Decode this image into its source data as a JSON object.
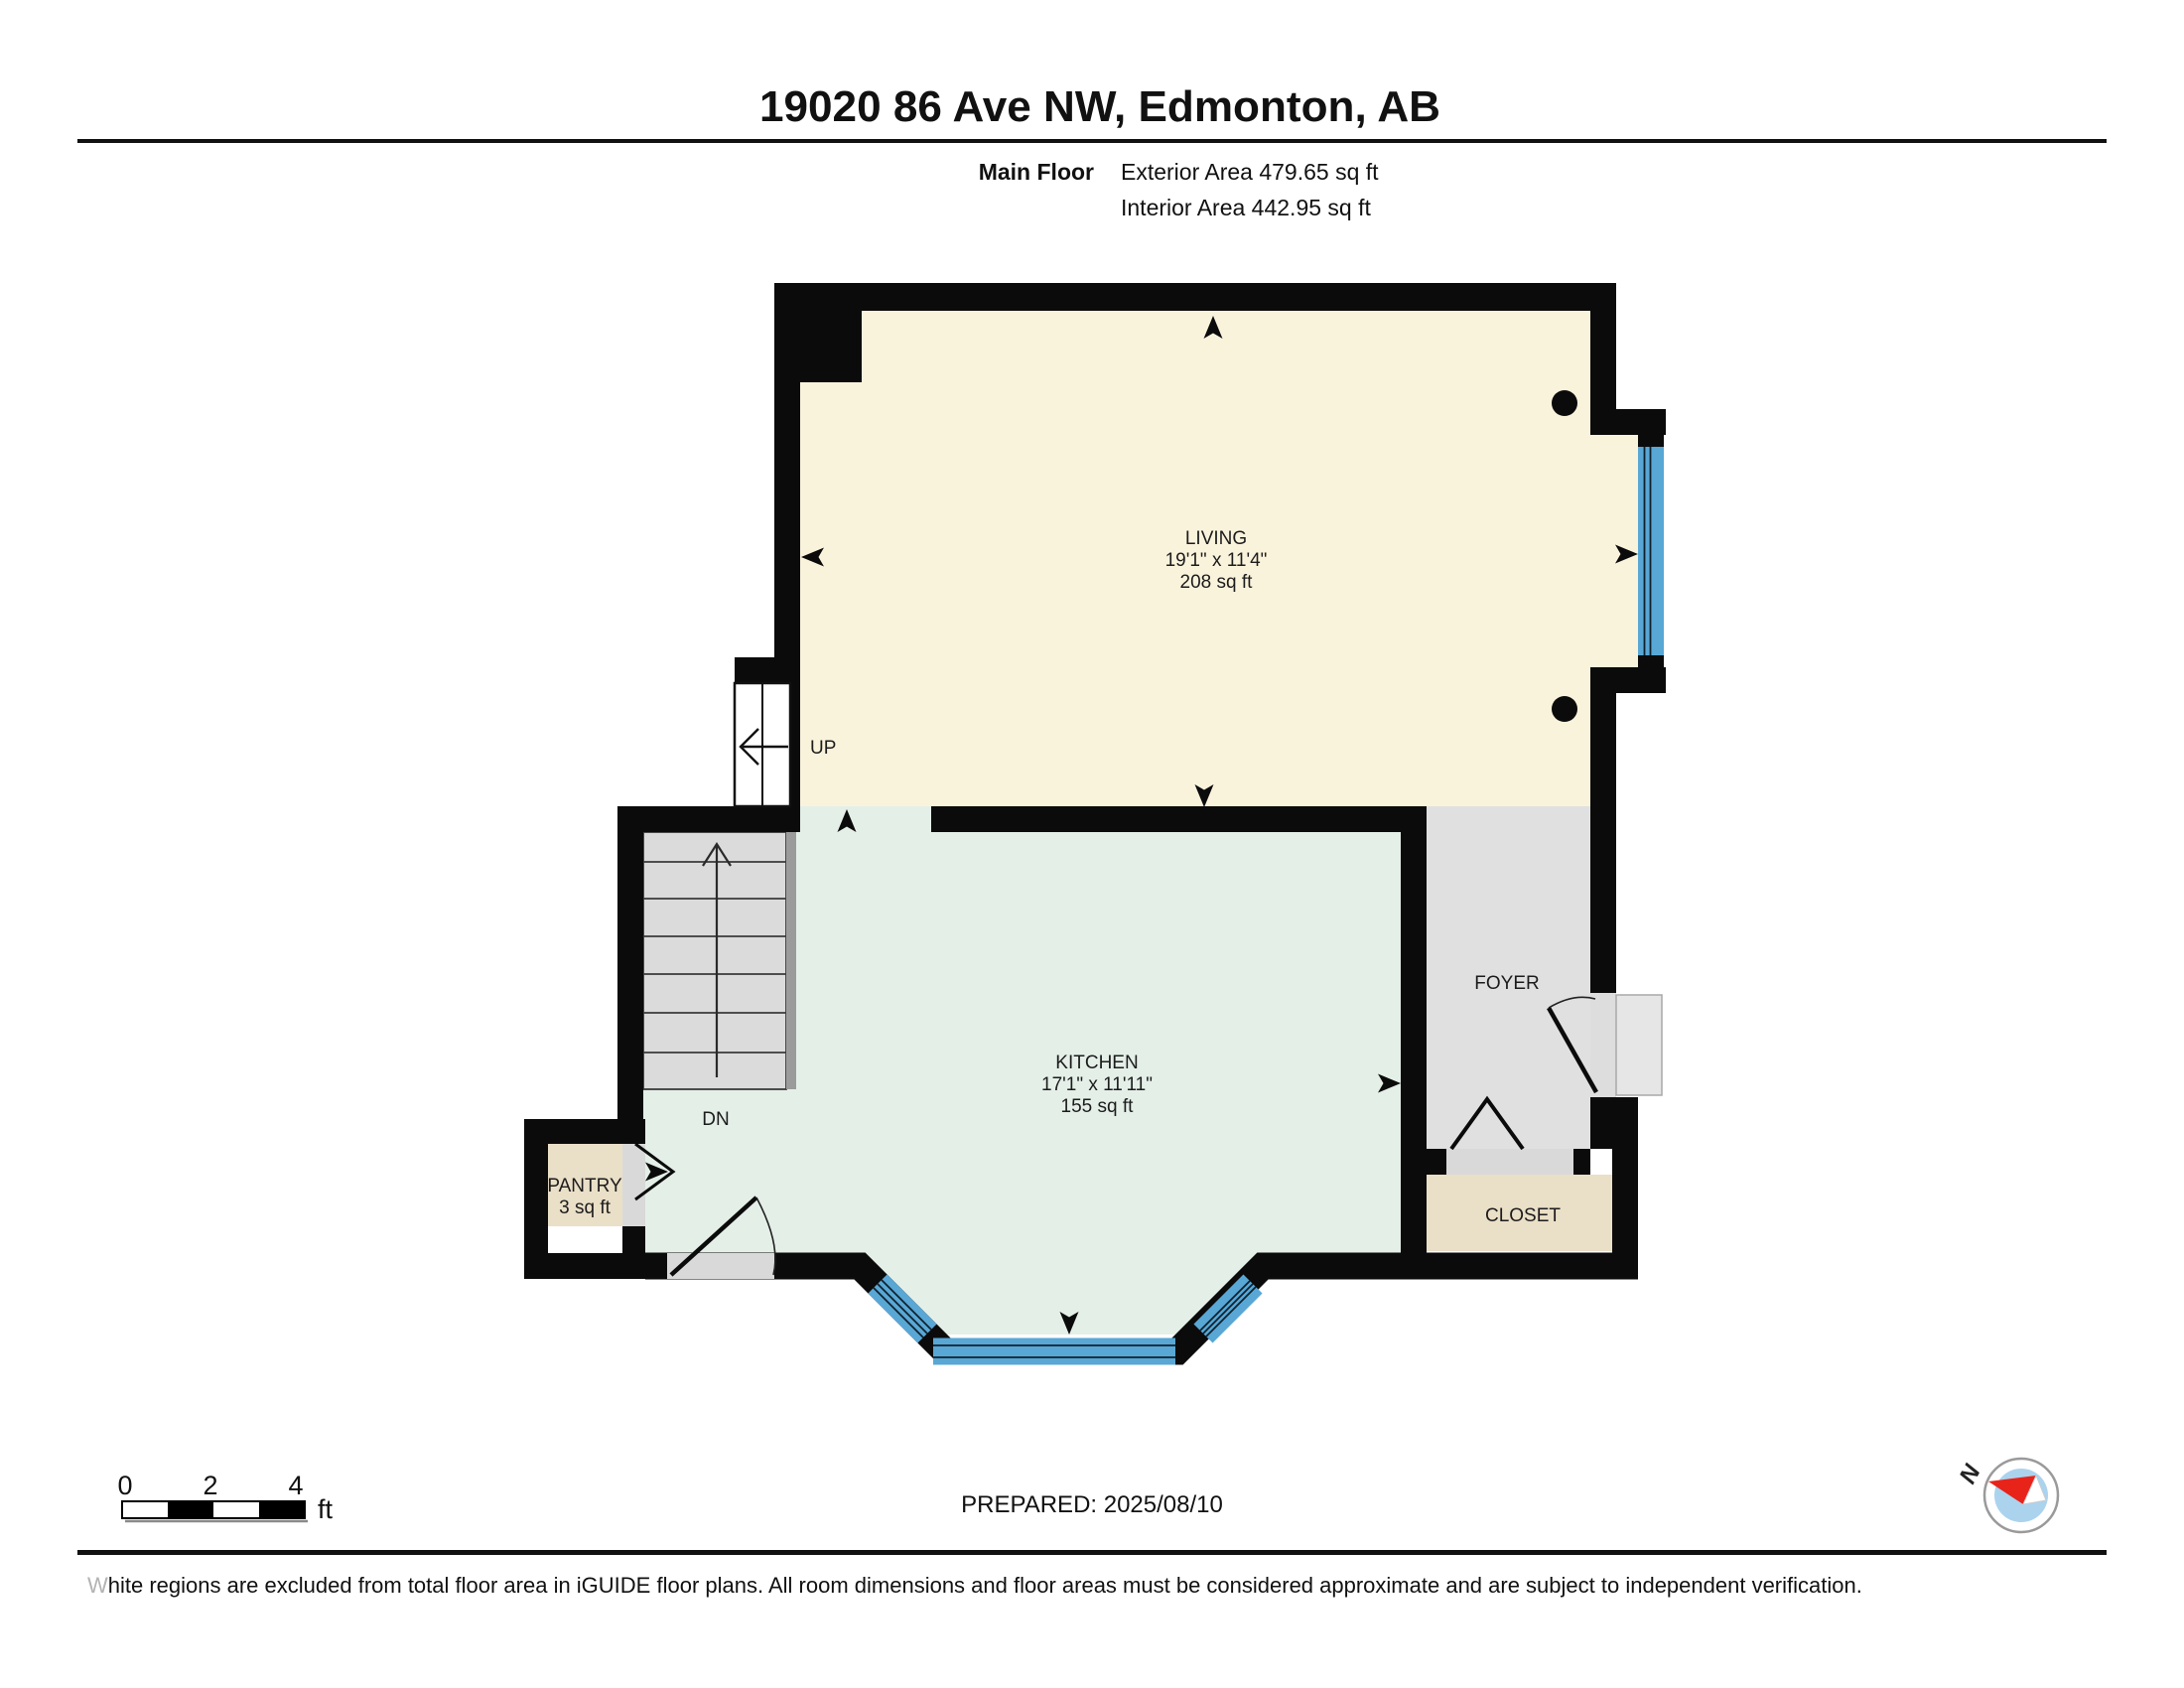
{
  "header": {
    "title": "19020 86 Ave NW, Edmonton, AB",
    "floor_label": "Main Floor",
    "exterior_area": "Exterior Area 479.65 sq ft",
    "interior_area": "Interior Area 442.95 sq ft"
  },
  "rooms": {
    "living": {
      "name": "LIVING",
      "dimensions": "19'1\" x 11'4\"",
      "area": "208 sq ft"
    },
    "kitchen": {
      "name": "KITCHEN",
      "dimensions": "17'1\" x 11'11\"",
      "area": "155 sq ft"
    },
    "foyer": {
      "name": "FOYER"
    },
    "closet": {
      "name": "CLOSET"
    },
    "pantry": {
      "name": "PANTRY",
      "area": "3 sq ft"
    }
  },
  "stairs": {
    "up": "UP",
    "down": "DN"
  },
  "scale_bar": {
    "t0": "0",
    "t2": "2",
    "t4": "4",
    "unit": "ft"
  },
  "compass": {
    "north": "N"
  },
  "footer": {
    "prepared": "PREPARED: 2025/08/10",
    "disclaimer_lead": "W",
    "disclaimer_rest": "hite regions are excluded from total floor area in iGUIDE floor plans. All room dimensions and floor areas must be considered approximate and are subject to independent verification."
  },
  "colors": {
    "living_fill": "#FAF3DC",
    "kitchen_fill": "#E4EFE8",
    "foyer_fill": "#E0E0E0",
    "closet_fill": "#EADFC7",
    "pantry_fill": "#EADFC7",
    "threshold_gray": "#D9D9D9",
    "stairs_fill": "#DBDBDB",
    "window_blue": "#58A7D5",
    "wall_black": "#0B0B0B",
    "compass_blue": "#ABD3EE",
    "compass_red": "#E8231A"
  }
}
